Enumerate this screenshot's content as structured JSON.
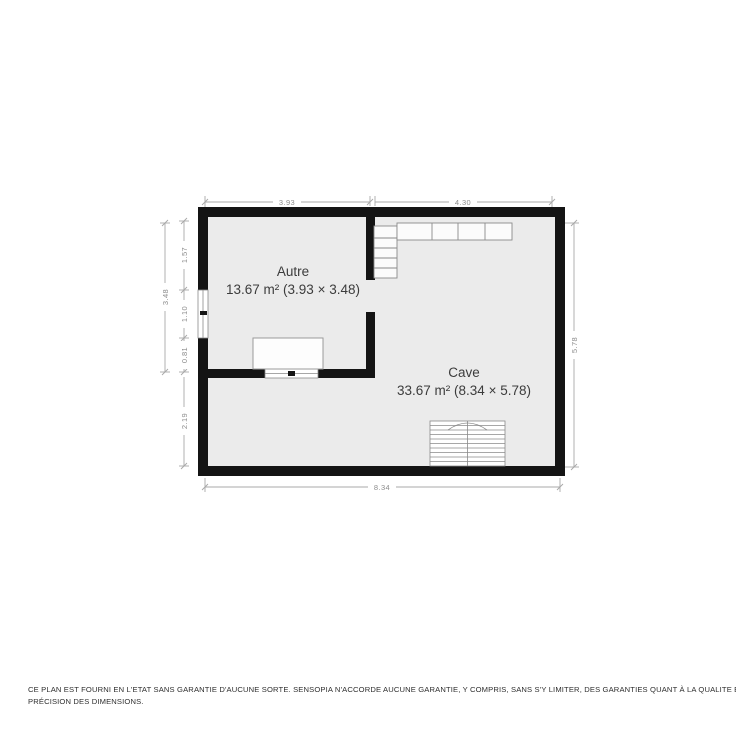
{
  "plan": {
    "rooms": [
      {
        "name": "Autre",
        "area_label": "13.67 m² (3.93 × 3.48)"
      },
      {
        "name": "Cave",
        "area_label": "33.67 m² (8.34 × 5.78)"
      }
    ],
    "dimensions": {
      "top_left": "3.93",
      "top_right": "4.30",
      "left_total": "3.48",
      "left_upper": "1.57",
      "left_window": "1.10",
      "left_lower": "0.81",
      "left_bottom": "2.19",
      "right": "5.78",
      "bottom": "8.34"
    },
    "colors": {
      "wall": "#141414",
      "floor": "#ebebeb",
      "dimension_line": "#a8a8a8",
      "dimension_text": "#8d8d8d",
      "room_text": "#3c3c3c"
    }
  },
  "footer": {
    "disclaimer_line1": "CE PLAN EST FOURNI EN L'ETAT SANS GARANTIE D'AUCUNE SORTE. SENSOPIA N'ACCORDE AUCUNE GARANTIE, Y COMPRIS, SANS S'Y LIMITER, DES GARANTIES QUANT À LA QUALITE ET À LA",
    "disclaimer_line2": "PRÉCISION DES DIMENSIONS."
  }
}
